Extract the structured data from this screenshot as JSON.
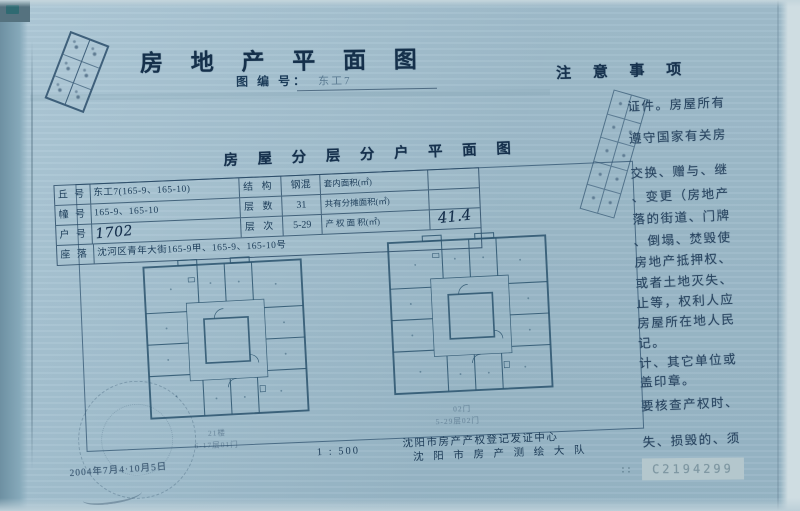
{
  "header": {
    "title": "房 地 产 平 面 图",
    "drawing_no_label": "图 编 号：",
    "drawing_no_value": "东工7"
  },
  "notes": {
    "title": "注 意 事 项",
    "lines": [
      "证件。房屋所有",
      "遵守国家有关房",
      "交换、赠与、继",
      "、变更（房地产",
      "落的街道、门牌",
      "、倒塌、焚毁使",
      "房地产抵押权、",
      "或者土地灭失、",
      "止等，权利人应",
      "房屋所在地人民",
      "记。",
      "计、其它单位或",
      "盖印章。",
      "要核查产权时、",
      "失、损毁的、须"
    ]
  },
  "section": {
    "title": "房 屋 分 层 分 户 平 面 图"
  },
  "table": {
    "rows": [
      {
        "label": "丘 号",
        "value": "东工7(165-9、165-10)",
        "attr_label": "结 构",
        "attr_value": "钢混",
        "area_label": "套内面积(㎡)",
        "area_value": ""
      },
      {
        "label": "幢 号",
        "value": "165-9、165-10",
        "attr_label": "层 数",
        "attr_value": "31",
        "area_label": "共有分摊面积(㎡)",
        "area_value": ""
      },
      {
        "label": "户 号",
        "value": "1702",
        "attr_label": "层 次",
        "attr_value": "5-29",
        "area_label": "产 权 面 积(㎡)",
        "area_value": "41.4"
      },
      {
        "label": "座 落",
        "value": "沈河区青年大街165-9甲、165-9、165-10号"
      }
    ]
  },
  "plans": {
    "left_caption_line1": "21楼",
    "left_caption_line2": "6-17层01门",
    "right_caption_line1": "02门",
    "right_caption_line2": "5-29层02门"
  },
  "footer": {
    "scale": "1 : 500",
    "org_line1": "沈阳市房产产权登记发证中心",
    "org_line2": "沈 阳 市 房 产 测 绘 大 队",
    "stamp_date": "2004年7月4·10月5日",
    "serial_colon": "::",
    "serial": "C2194299"
  }
}
